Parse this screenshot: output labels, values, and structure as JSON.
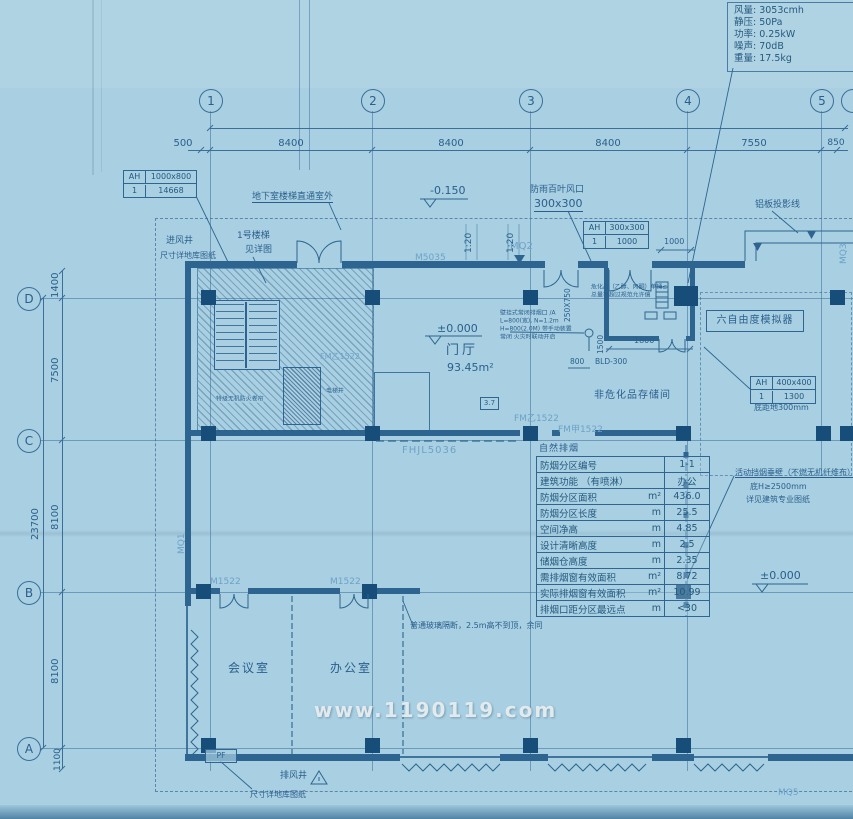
{
  "spec_box": {
    "lines": [
      "风量: 3053cmh",
      "静压: 50Pa",
      "功率: 0.25kW",
      "噪声: 70dB",
      "重量: 17.5kg"
    ]
  },
  "grid": {
    "top_axes": [
      "1",
      "2",
      "3",
      "4",
      "5"
    ],
    "left_axes": [
      "D",
      "C",
      "B",
      "A"
    ],
    "top_dims": {
      "d500": "500",
      "d8400a": "8400",
      "d8400b": "8400",
      "d8400c": "8400",
      "d7550": "7550",
      "d850": "850"
    },
    "left_dims": {
      "d1400": "1400",
      "d7500": "7500",
      "d8100a": "8100",
      "d8100b": "8100",
      "d1100": "1100",
      "total": "23700"
    }
  },
  "ah1": {
    "tag": "AH",
    "size": "1000x800",
    "num": "1",
    "val": "14668"
  },
  "ah2": {
    "tag": "AH",
    "size": "300x300",
    "num": "1",
    "val": "1000"
  },
  "ah3": {
    "tag": "AH",
    "size": "400x400",
    "num": "1",
    "val": "1300",
    "note": "底距地300mm"
  },
  "levels": {
    "minus": "-0.150",
    "zero": "±0.000",
    "zero_right": "±0.000"
  },
  "labels": {
    "underground_stair": "地下室楼梯直通室外",
    "air_inlet": "进风井",
    "air_inlet_note": "尺寸详地库图纸",
    "stair1": "1号楼梯",
    "stair1_note": "见详图",
    "rain_louver": "防雨百叶风口",
    "rain_louver_size": "300x300",
    "slope": "1:20",
    "m5035": "M5035",
    "mq2": "MQ2",
    "mq1": "MQ1",
    "mq3": "MQ3",
    "mq5": "MQ5",
    "alum": "铝板投影线",
    "lobby": "门厅",
    "lobby_area": "93.45m²",
    "storage": "非危化品存储间",
    "simulator": "六自由度模拟器",
    "ref37": "3.7",
    "fm_yi": "FM乙1522",
    "fm_jia": "FM甲1522",
    "fm_stair": "FM乙1522",
    "fhjl": "FHJL5036",
    "m1522": "M1522",
    "meeting": "会议室",
    "office": "办公室",
    "glass_note": "普通玻璃隔断，2.5m高不到顶，余同",
    "curtain1": "活动挡烟垂壁（不燃无机纤维布）",
    "curtain2": "底H≥2500mm",
    "curtain3": "详见建筑专业图纸",
    "pf": "PF",
    "exhaust": "排风井",
    "exhaust_note": "尺寸详地库图纸",
    "shutter": "特级无机防火卷帘",
    "elevator": "电梯井"
  },
  "notes": {
    "note_a": [
      "壁挂式常闭排烟口 /A",
      "L=800(宽), N=1.2m",
      "H=800(2.0M) 带手动装置",
      "常闭 火灾时联动开启"
    ],
    "note_b": [
      "危化品（乙醇、丙酮）单桶≤",
      "总量不超过规范允许值"
    ]
  },
  "dims": {
    "d1000": "1000",
    "d1800": "1800",
    "d800": "800",
    "d1500": "1500",
    "d250x750": "250X750",
    "bld": "BLD-300"
  },
  "table": {
    "title": "自然排烟",
    "rows": [
      {
        "label": "防烟分区编号",
        "unit": "",
        "value": "1-1"
      },
      {
        "label": "建筑功能 （有喷淋）",
        "unit": "",
        "value": "办公"
      },
      {
        "label": "防烟分区面积",
        "unit": "m²",
        "value": "436.0"
      },
      {
        "label": "防烟分区长度",
        "unit": "m",
        "value": "25.5"
      },
      {
        "label": "空间净高",
        "unit": "m",
        "value": "4.85"
      },
      {
        "label": "设计清晰高度",
        "unit": "m",
        "value": "2.5"
      },
      {
        "label": "储烟仓高度",
        "unit": "m",
        "value": "2.35"
      },
      {
        "label": "需排烟窗有效面积",
        "unit": "m²",
        "value": "8.72"
      },
      {
        "label": "实际排烟窗有效面积",
        "unit": "m²",
        "value": "10.99"
      },
      {
        "label": "排烟口距分区最远点",
        "unit": "m",
        "value": "<30"
      }
    ]
  },
  "watermark": "www.1190119.com"
}
